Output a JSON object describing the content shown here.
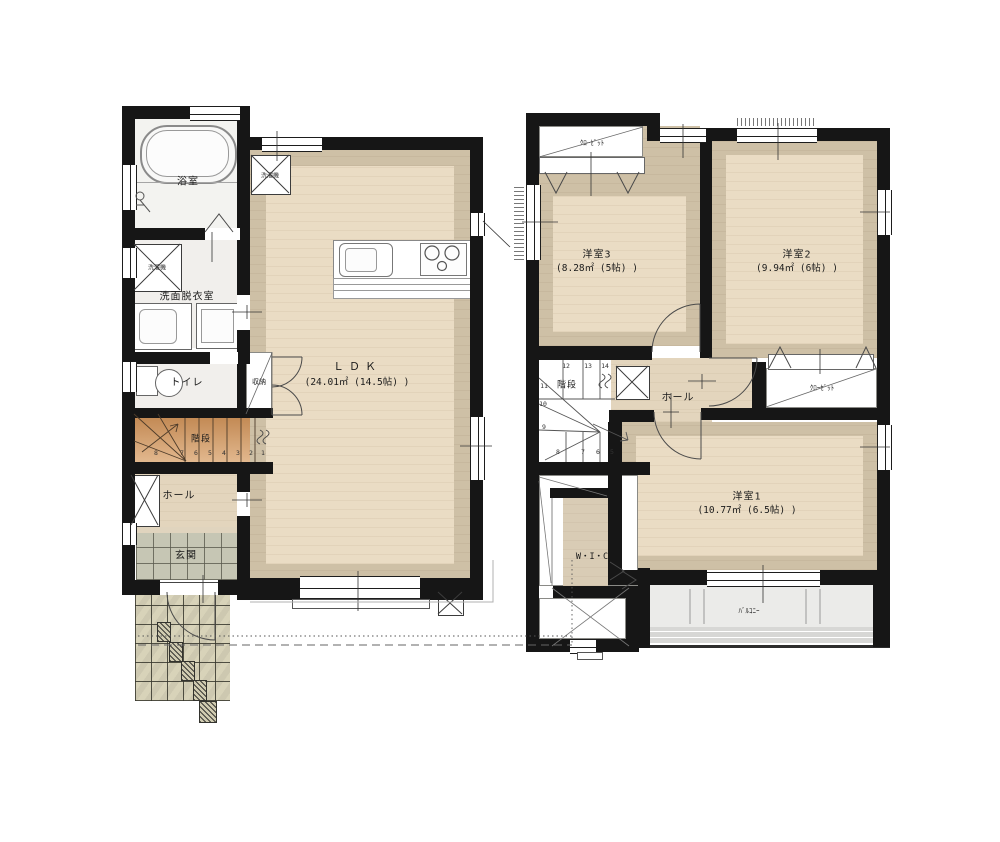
{
  "colors": {
    "wall": "#161616",
    "wood_light": "#eadcc4",
    "wood_dark": "#cec0a6",
    "hall_wood": "#e3d5bd",
    "stairs_wood": "#d3a172",
    "entry_tile": "#c6c6b4",
    "porch_tile": "#d8d3b9",
    "balcony": "#ebebe9"
  },
  "floor1": {
    "bath": {
      "label": "浴室"
    },
    "washroom": {
      "label": "洗面脱衣室",
      "washer_label": "洗濯機"
    },
    "toilet": {
      "label": "トイレ"
    },
    "storage": {
      "label": "収納"
    },
    "stairs": {
      "label": "階段",
      "numbers": [
        "8",
        "7",
        "6",
        "5",
        "4",
        "3",
        "2",
        "1"
      ]
    },
    "hall": {
      "label": "ホール"
    },
    "entrance": {
      "label": "玄関"
    },
    "ldk": {
      "label": "ＬＤＫ",
      "area": "(24.01㎡ (14.5帖) )",
      "washer_label": "洗濯機"
    }
  },
  "floor2": {
    "closet_top": {
      "label": "ｸﾛｰｾﾞｯﾄ"
    },
    "room3": {
      "label": "洋室3",
      "area": "(8.28㎡ (5帖) )"
    },
    "room2": {
      "label": "洋室2",
      "area": "(9.94㎡ (6帖) )"
    },
    "stairs": {
      "label": "階段",
      "numbers_top": [
        "12",
        "13",
        "14"
      ],
      "numbers_left": [
        "11",
        "10",
        "9"
      ],
      "numbers_bottom": [
        "8",
        "7",
        "6",
        "5"
      ]
    },
    "hall": {
      "label": "ホール"
    },
    "closet_mid": {
      "label": "ｸﾛｰｾﾞｯﾄ"
    },
    "room1": {
      "label": "洋室1",
      "area": "(10.77㎡ (6.5帖) )"
    },
    "wic": {
      "label": "W・I・C"
    },
    "balcony": {
      "label": "ﾊﾞﾙｺﾆｰ"
    }
  }
}
